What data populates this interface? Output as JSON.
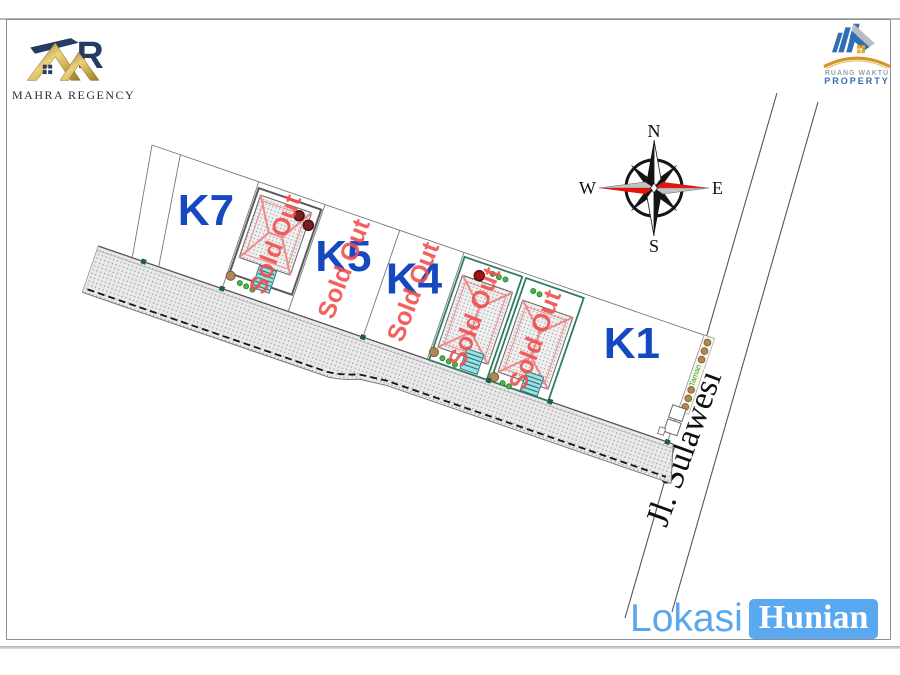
{
  "header": {
    "left_logo": {
      "title": "MAHRA REGENCY"
    },
    "right_logo": {
      "line1": "RUANG WAKTU",
      "line2": "PROPERTY"
    }
  },
  "compass": {
    "north": "N",
    "south": "S",
    "east": "E",
    "west": "W"
  },
  "site_plan": {
    "street_label": "Jl. Sulawesi",
    "garden_label": "Taman",
    "sold_out_label": "Sold Out",
    "plots": {
      "k7": "K7",
      "k5": "K5",
      "k4": "K4",
      "k1": "K1"
    }
  },
  "footer": {
    "lokasi": "Lokasi",
    "hunian": "Hunian"
  },
  "colors": {
    "plot_label_blue": "#1648c0",
    "sold_out_red": "#f0504f",
    "accent_blue": "#5aa8ef",
    "logo_gold": "#c99a3f",
    "logo_navy": "#243b63",
    "boundary_green": "#2e7d62",
    "compass_red": "#e3150f"
  }
}
